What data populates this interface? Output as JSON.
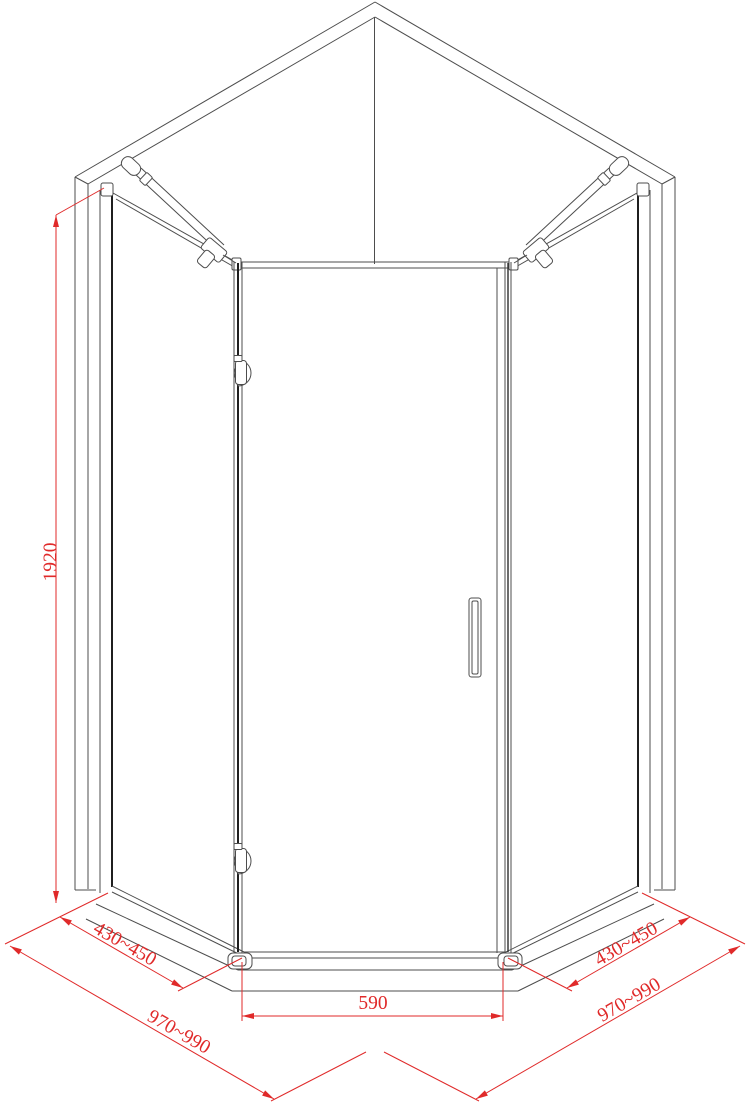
{
  "drawing": {
    "title": "pentagonal shower enclosure technical drawing",
    "colors": {
      "background": "#ffffff",
      "outline": "#4d4d4d",
      "glass_edge": "#1f1f1f",
      "dimension": "#e02a2a"
    },
    "dimensions": {
      "height": "1920",
      "left_chamfer": "430~450",
      "right_chamfer": "430~450",
      "door_width": "590",
      "left_width": "970~990",
      "right_width": "970~990"
    }
  }
}
